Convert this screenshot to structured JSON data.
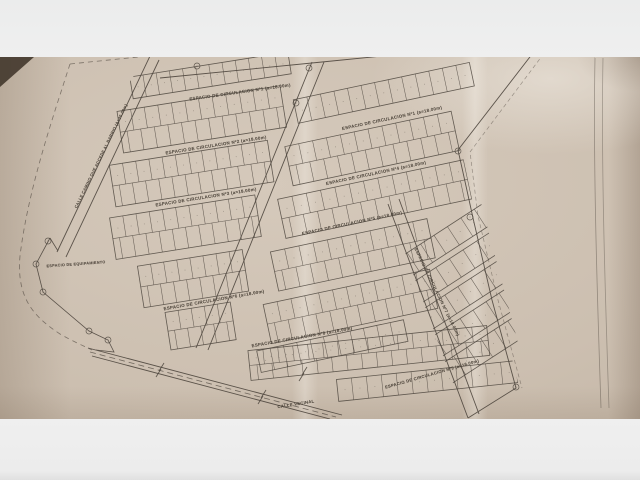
{
  "scene": {
    "background_color": "#ededee",
    "paper_color": "#ccbfb0",
    "ink_color": "#4e463e",
    "table_color": "#43372c"
  },
  "plan": {
    "labels": [
      {
        "name": "street-label-espacio-circulacion-1a",
        "text": "ESPACIO DE CIRCULACION Nº1 (a=18.00m)",
        "x": 240,
        "y": 92,
        "rot": -8,
        "size": 4.4
      },
      {
        "name": "street-label-espacio-circulacion-1b",
        "text": "ESPACIO DE CIRCULACION Nº1 (a=18.00m)",
        "x": 392,
        "y": 118,
        "rot": -12,
        "size": 4.4
      },
      {
        "name": "street-label-espacio-circulacion-2",
        "text": "ESPACIO DE CIRCULACION Nº2 (a=18.00m)",
        "x": 216,
        "y": 145,
        "rot": -9,
        "size": 4.4
      },
      {
        "name": "street-label-espacio-circulacion-3",
        "text": "ESPACIO DE CIRCULACION Nº3 (a=18.00m)",
        "x": 206,
        "y": 197,
        "rot": -9,
        "size": 4.4
      },
      {
        "name": "street-label-espacio-circulacion-4",
        "text": "ESPACIO DE CIRCULACION Nº4 (a=18.00m)",
        "x": 376,
        "y": 173,
        "rot": -12,
        "size": 4.4
      },
      {
        "name": "street-label-espacio-circulacion-5",
        "text": "ESPACIO DE CIRCULACION Nº5 (a=18.00m)",
        "x": 352,
        "y": 223,
        "rot": -12,
        "size": 4.4
      },
      {
        "name": "street-label-espacio-circulacion-6",
        "text": "ESPACIO DE CIRCULACION Nº6 (a=18.00m)",
        "x": 214,
        "y": 300,
        "rot": -10,
        "size": 4.4
      },
      {
        "name": "street-label-espacio-circulacion-7",
        "text": "ESPACIO DE CIRCULACION Nº7 (a=18.00m)",
        "x": 437,
        "y": 292,
        "rot": 64,
        "size": 4.2
      },
      {
        "name": "street-label-espacio-circulacion-8",
        "text": "ESPACIO DE CIRCULACION Nº8 (a=18.00m)",
        "x": 302,
        "y": 337,
        "rot": -10,
        "size": 4.4
      },
      {
        "name": "street-label-espacio-circulacion-9",
        "text": "ESPACIO DE CIRCULACION Nº9 (a=18.00m)",
        "x": 432,
        "y": 374,
        "rot": -16,
        "size": 4.2
      },
      {
        "name": "road-label-calle-camino",
        "text": "CALLE CAMINO QUE ACCEDE AL BARRIO (A=20.00m)",
        "x": 101,
        "y": 156,
        "rot": -64,
        "size": 4.0
      },
      {
        "name": "area-label-espacio-equipamiento",
        "text": "ESPACIO DE EQUIPAMIENTO",
        "x": 76,
        "y": 264,
        "rot": -4,
        "size": 3.8
      },
      {
        "name": "road-label-calle-vecinal",
        "text": "CALLE VECINAL",
        "x": 296,
        "y": 404,
        "rot": -9,
        "size": 4.2
      }
    ],
    "blocks": [
      {
        "section": "left",
        "x": 150,
        "y": 66,
        "w": 160,
        "h": 22,
        "rows": 1,
        "lots": 12
      },
      {
        "section": "left",
        "x": 132,
        "y": 98,
        "w": 165,
        "h": 42,
        "rows": 2,
        "lots": 12
      },
      {
        "section": "left",
        "x": 116,
        "y": 150,
        "w": 160,
        "h": 42,
        "rows": 2,
        "lots": 12
      },
      {
        "section": "left",
        "x": 108,
        "y": 202,
        "w": 147,
        "h": 42,
        "rows": 2,
        "lots": 11
      },
      {
        "section": "left",
        "x": 128,
        "y": 254,
        "w": 106,
        "h": 42,
        "rows": 2,
        "lots": 8
      },
      {
        "section": "left",
        "x": 148,
        "y": 304,
        "w": 66,
        "h": 38,
        "rows": 2,
        "lots": 5
      },
      {
        "section": "right",
        "x": 316,
        "y": 84,
        "w": 180,
        "h": 24,
        "rows": 1,
        "lots": 13
      },
      {
        "section": "right",
        "x": 298,
        "y": 128,
        "w": 170,
        "h": 40,
        "rows": 2,
        "lots": 12
      },
      {
        "section": "right",
        "x": 280,
        "y": 178,
        "w": 190,
        "h": 40,
        "rows": 2,
        "lots": 13
      },
      {
        "section": "right",
        "x": 262,
        "y": 228,
        "w": 160,
        "h": 40,
        "rows": 2,
        "lots": 11
      },
      {
        "section": "right",
        "x": 244,
        "y": 278,
        "w": 170,
        "h": 40,
        "rows": 2,
        "lots": 12
      },
      {
        "section": "right",
        "x": 228,
        "y": 322,
        "w": 150,
        "h": 22,
        "rows": 1,
        "lots": 11
      },
      {
        "section": "fan",
        "x": 340,
        "y": 230,
        "w": 240,
        "h": 22,
        "rows": 1,
        "lots": 15
      },
      {
        "section": "fan",
        "x": 338,
        "y": 258,
        "w": 244,
        "h": 22,
        "rows": 1,
        "lots": 15
      },
      {
        "section": "fan",
        "x": 336,
        "y": 286,
        "w": 248,
        "h": 22,
        "rows": 1,
        "lots": 16
      },
      {
        "section": "fan",
        "x": 336,
        "y": 314,
        "w": 248,
        "h": 22,
        "rows": 1,
        "lots": 16
      },
      {
        "section": "fan",
        "x": 338,
        "y": 342,
        "w": 242,
        "h": 22,
        "rows": 1,
        "lots": 15
      },
      {
        "section": "bottom",
        "x": 250,
        "y": 340,
        "w": 240,
        "h": 30,
        "rows": 2,
        "lots": 16
      },
      {
        "section": "bottom",
        "x": 335,
        "y": 378,
        "w": 180,
        "h": 22,
        "rows": 1,
        "lots": 12
      }
    ],
    "vertex_markers": [
      [
        197,
        66
      ],
      [
        309,
        68
      ],
      [
        296,
        103
      ],
      [
        458,
        151
      ],
      [
        542,
        41
      ],
      [
        470,
        217
      ],
      [
        516,
        387
      ],
      [
        48,
        241
      ],
      [
        36,
        264
      ],
      [
        43,
        292
      ],
      [
        89,
        331
      ],
      [
        108,
        340
      ]
    ],
    "line_breaks": [
      [
        160,
        370
      ],
      [
        262,
        397
      ],
      [
        303,
        374
      ]
    ]
  }
}
